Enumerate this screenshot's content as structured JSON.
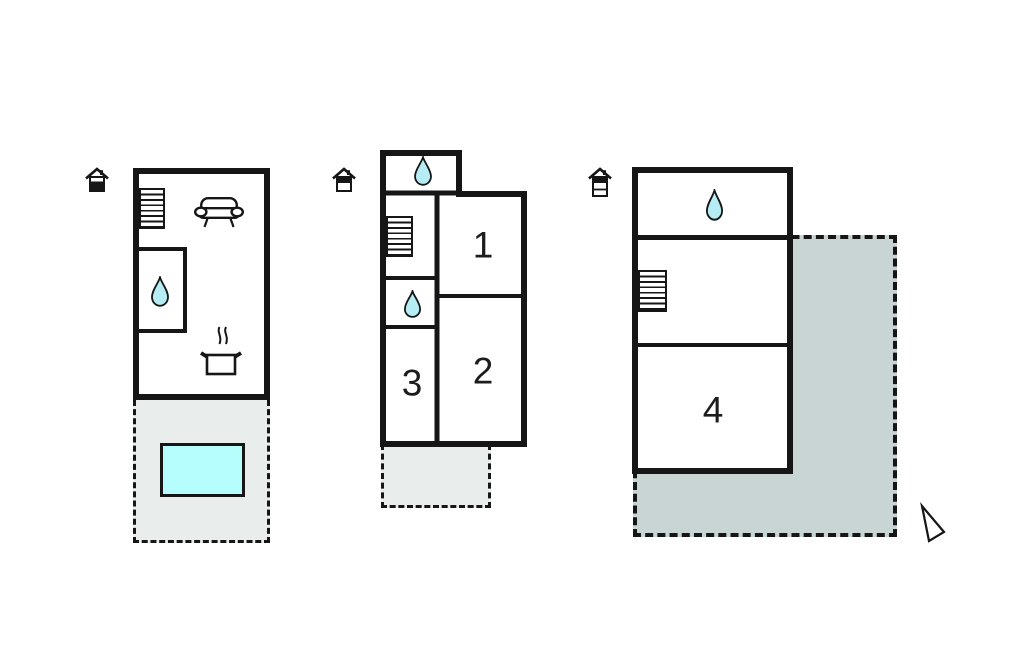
{
  "colors": {
    "wall": "#161616",
    "water_drop_fill": "#b6ecf4",
    "pool_fill": "#b6fdfd",
    "terrace_light_fill": "#e9edeb",
    "terrace_dark_fill": "#c9d5d4",
    "background": "#ffffff"
  },
  "rooms": {
    "room1": "1",
    "room2": "2",
    "room3": "3",
    "room4": "4"
  },
  "icons": {
    "left_house": "house-level-indicator-lower-filled",
    "middle_house": "house-level-indicator-upper-filled",
    "right_house": "house-level-indicator-three-rows-top-filled",
    "water_drop": "water-drop",
    "stairs": "staircase",
    "sofa": "sofa",
    "pot": "cooking-pot-with-steam",
    "pool": "swimming-pool",
    "compass": "north-arrow"
  }
}
